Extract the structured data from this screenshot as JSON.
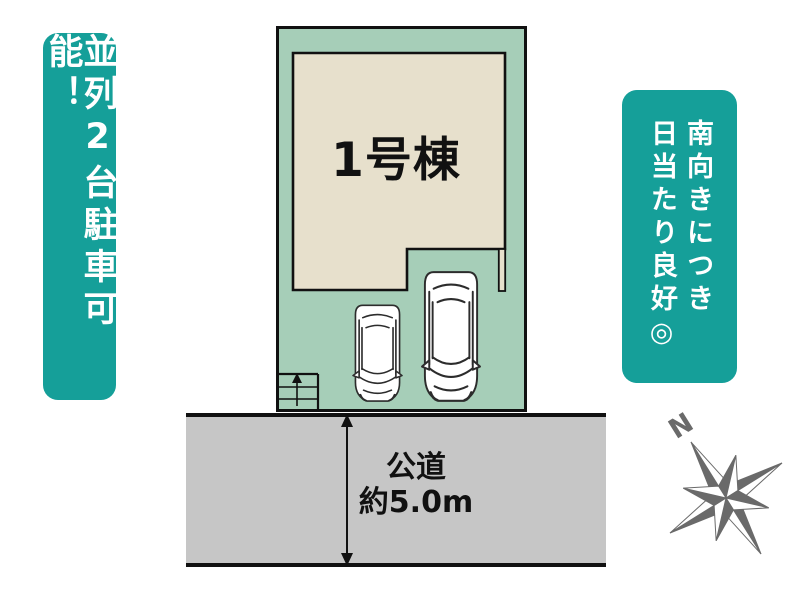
{
  "banners": {
    "parking": {
      "text": "並列2台駐車可能！"
    },
    "sunlight": {
      "line1": "南向きにつき",
      "line2": "日当たり良好◎"
    }
  },
  "site": {
    "building_label": "1号棟",
    "road": {
      "name": "公道",
      "width": "約5.0m"
    },
    "compass_north": "N"
  },
  "colors": {
    "banner_teal": "#159f99",
    "lot_green": "#a6ceb8",
    "building_beige": "#e7e0cc",
    "road_gray": "#c6c6c6",
    "outline_black": "#111111",
    "compass_gray": "#6a6a6a"
  }
}
